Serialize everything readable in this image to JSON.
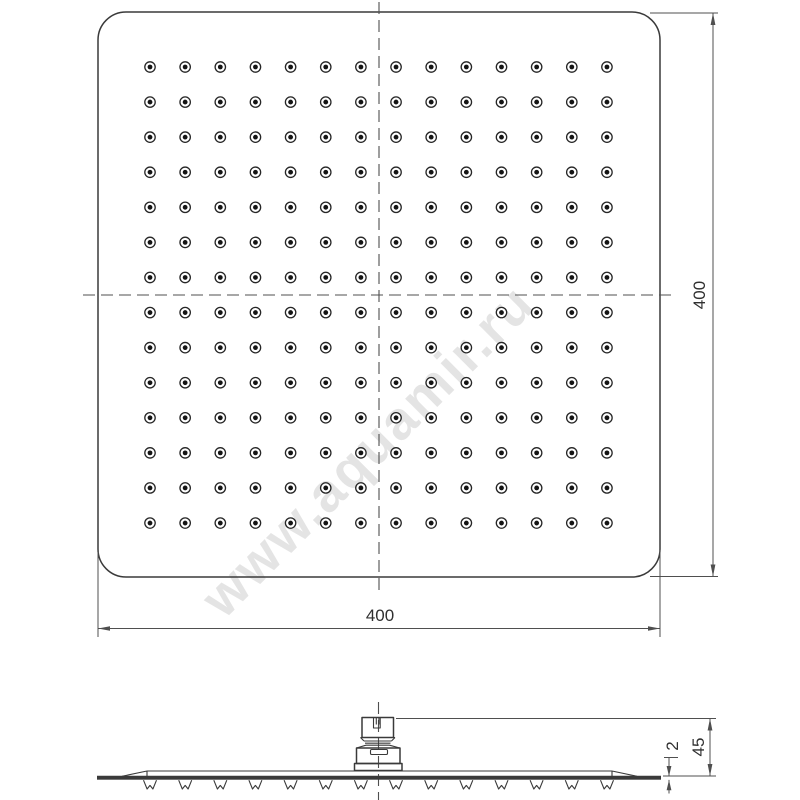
{
  "colors": {
    "line": "#3a3a3a",
    "dim": "#4f4f4f",
    "watermark": "#e2e2e2",
    "watermark_highlight": "#ffffff",
    "background": "#ffffff"
  },
  "watermark": {
    "text": "www.aquamir.ru"
  },
  "top_view": {
    "dim_width_label": "400",
    "dim_height_label": "400",
    "grid": {
      "cols": 14,
      "rows": 14,
      "x0": 150,
      "y0": 67,
      "dx": 35.15,
      "dy": 35.08,
      "outer_r": 5.2,
      "inner_r": 2.4
    }
  },
  "side_view": {
    "dim_total_height_label": "45",
    "dim_plate_thickness_label": "2",
    "nozzles": {
      "count": 14,
      "x0": 150,
      "dx": 35.15,
      "top_y": 780.2,
      "height": 8.8,
      "half_width": 6.5,
      "notch_rise": 3.6
    }
  }
}
